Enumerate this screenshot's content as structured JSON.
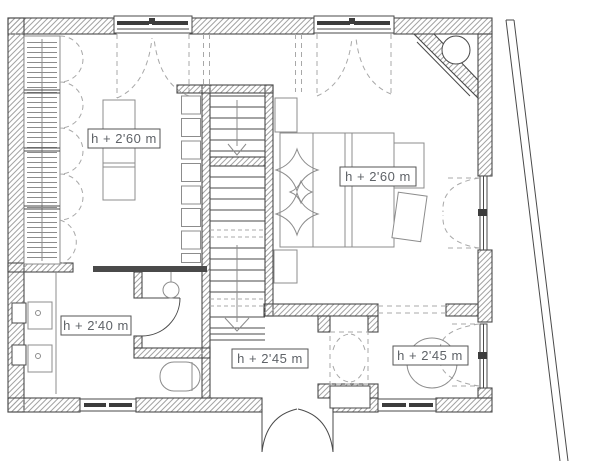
{
  "plan": {
    "type": "architectural-floor-plan",
    "labels": {
      "living": "h + 2'60 m",
      "bedroom": "h + 2'60 m",
      "laundry": "h + 2'40 m",
      "hall": "h + 2'45 m",
      "dining": "h + 2'45 m"
    },
    "colors": {
      "background": "#ffffff",
      "wall_line": "#4a4a4a",
      "hatch": "#a3a3a3",
      "dashed": "#a8a8a8",
      "furniture": "#8c8c8c",
      "glazing": "#3c3c3c",
      "label_border": "#555555",
      "label_text": "#5f6368"
    }
  }
}
